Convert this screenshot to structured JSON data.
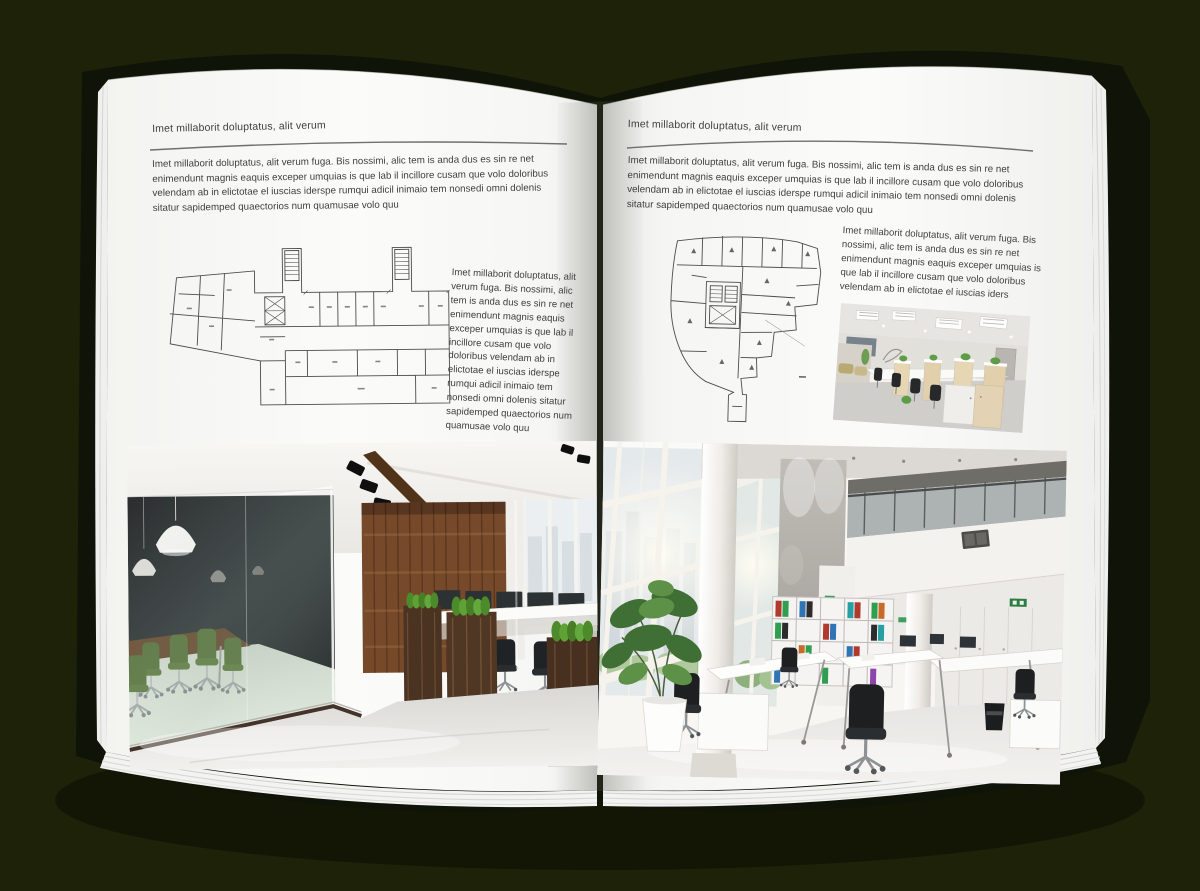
{
  "document_type": "architecture-brochure-spread-mockup",
  "colors": {
    "backdrop": "#1e2209",
    "book_cover": "#101307",
    "page": "#fbfbfa",
    "body_text": "#3f3f3f",
    "header_rule": "#6f6f6f"
  },
  "left_page": {
    "kicker": "Imet millaborit doluptatus, alit verum",
    "intro": "Imet millaborit doluptatus, alit verum fuga. Bis nossimi, alic tem is anda dus es sin re net enimendunt magnis eaquis exceper umquias is que lab il incillore cusam que volo doloribus velendam ab in elictotae el iuscias iderspe rumqui adicil inimaio tem nonsedi omni dolenis sitatur sapidemped quaectorios num quamusae volo quu",
    "caption": "Imet millaborit doluptatus, alit verum fuga. Bis nossimi, alic tem is anda dus es sin re net enimendunt magnis eaquis exceper umquias is que lab il incillore cusam que volo doloribus velendam ab in elictotae el iuscias iderspe rumqui adicil inimaio tem nonsedi omni dolenis sitatur sapidemped quaectorios num quamusae volo quu"
  },
  "right_page": {
    "kicker": "Imet millaborit doluptatus, alit verum",
    "intro": "Imet millaborit doluptatus, alit verum fuga. Bis nossimi, alic tem is anda dus es sin re net enimendunt magnis eaquis exceper umquias is que lab il incillore cusam que volo doloribus velendam ab in elictotae el iuscias iderspe rumqui adicil inimaio tem nonsedi omni dolenis sitatur sapidemped quaectorios num quamusae volo quu",
    "caption": "Imet millaborit doluptatus, alit verum fuga. Bis nossimi, alic tem is anda dus es sin re net enimendunt magnis eaquis exceper umquias is que lab il incillore cusam que volo doloribus velendam ab in elictotae el iuscias iders"
  }
}
